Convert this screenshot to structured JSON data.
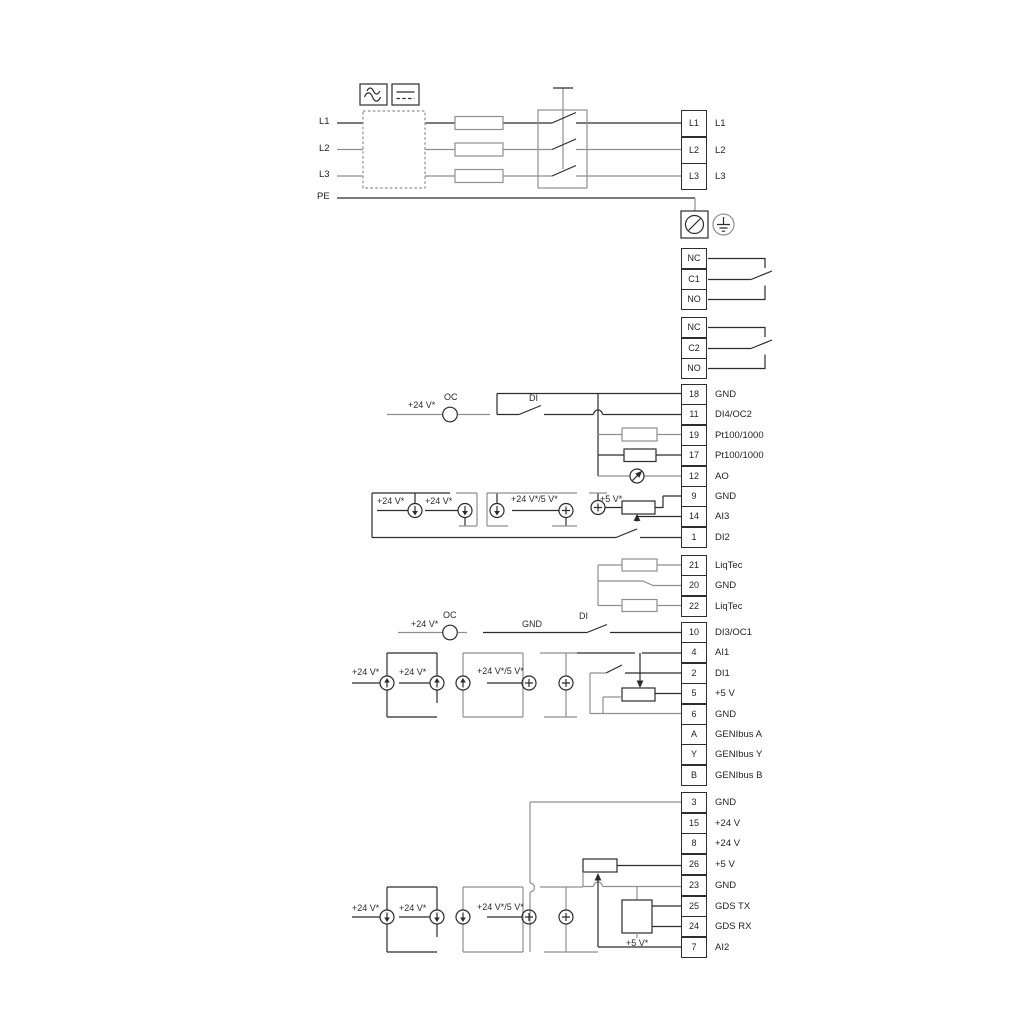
{
  "power_in": [
    "L1",
    "L2",
    "L3",
    "PE"
  ],
  "power_out": [
    "L1",
    "L2",
    "L3"
  ],
  "relay1": [
    "NC",
    "C1",
    "NO"
  ],
  "relay2": [
    "NC",
    "C2",
    "NO"
  ],
  "io_terminals": [
    {
      "num": "18",
      "label": "GND"
    },
    {
      "num": "11",
      "label": "DI4/OC2"
    },
    {
      "num": "19",
      "label": "Pt100/1000"
    },
    {
      "num": "17",
      "label": "Pt100/1000"
    },
    {
      "num": "12",
      "label": "AO"
    },
    {
      "num": "9",
      "label": "GND"
    },
    {
      "num": "14",
      "label": "AI3"
    },
    {
      "num": "1",
      "label": "DI2"
    }
  ],
  "liqtec_terminals": [
    {
      "num": "21",
      "label": "LiqTec"
    },
    {
      "num": "20",
      "label": "GND"
    },
    {
      "num": "22",
      "label": "LiqTec"
    }
  ],
  "mid_terminals": [
    {
      "num": "10",
      "label": "DI3/OC1"
    },
    {
      "num": "4",
      "label": "AI1"
    },
    {
      "num": "2",
      "label": "DI1"
    },
    {
      "num": "5",
      "label": "+5 V"
    },
    {
      "num": "6",
      "label": "GND"
    },
    {
      "num": "A",
      "label": "GENIbus A"
    },
    {
      "num": "Y",
      "label": "GENIbus Y"
    },
    {
      "num": "B",
      "label": "GENIbus B"
    }
  ],
  "bottom_terminals": [
    {
      "num": "3",
      "label": "GND"
    },
    {
      "num": "15",
      "label": "+24 V"
    },
    {
      "num": "8",
      "label": "+24 V"
    },
    {
      "num": "26",
      "label": "+5 V"
    },
    {
      "num": "23",
      "label": "GND"
    },
    {
      "num": "25",
      "label": "GDS TX"
    },
    {
      "num": "24",
      "label": "GDS RX"
    },
    {
      "num": "7",
      "label": "AI2"
    }
  ],
  "notes": [
    {
      "t": "+24 V*"
    },
    {
      "t": "OC"
    },
    {
      "t": "DI"
    },
    {
      "t": "+24 V*"
    },
    {
      "t": "+24 V*"
    },
    {
      "t": "+24 V*/5 V*"
    },
    {
      "t": "+5 V*"
    },
    {
      "t": "+24 V*"
    },
    {
      "t": "OC"
    },
    {
      "t": "GND"
    },
    {
      "t": "DI"
    },
    {
      "t": "+24 V*"
    },
    {
      "t": "+24 V*"
    },
    {
      "t": "+24 V*/5 V*"
    },
    {
      "t": "+24 V*"
    },
    {
      "t": "+24 V*"
    },
    {
      "t": "+24 V*/5 V*"
    },
    {
      "t": "+5 V*"
    }
  ],
  "icons": {
    "ac": "ac-waveform-icon",
    "dc": "dc-level-icon",
    "screw": "cable-screw-terminal-icon",
    "earth": "earth-ground-icon",
    "meter": "analog-output-meter-icon"
  },
  "colors": {
    "wire_dark": "#2b2b2b",
    "wire_gray": "#8f8f8f",
    "background": "#ffffff"
  }
}
